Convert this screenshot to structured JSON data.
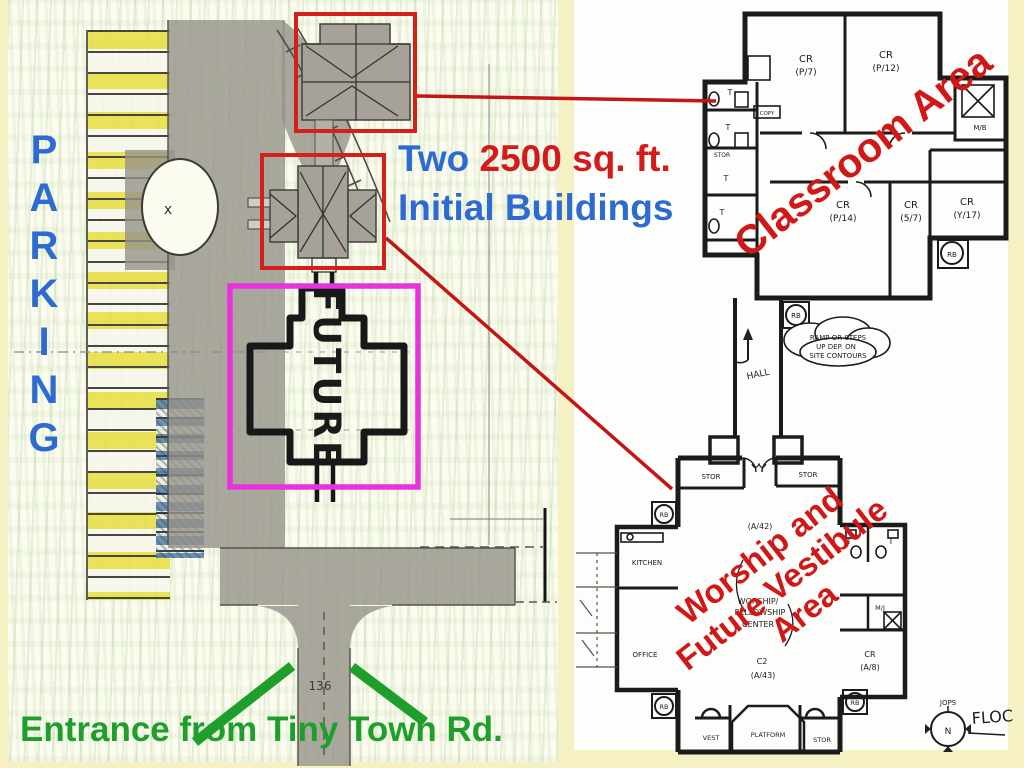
{
  "slide": {
    "caption": {
      "word_two": "Two",
      "size": "2500 sq. ft.",
      "line2": "Initial Buildings"
    },
    "parking_letters": [
      "P",
      "A",
      "R",
      "K",
      "I",
      "N",
      "G"
    ],
    "entrance_label": "Entrance from Tiny Town Rd.",
    "future_label": "FUTURE",
    "island_mark": "x",
    "drive_dimension": "136"
  },
  "classroom": {
    "title": "Classroom Area",
    "cr": "CR",
    "r1": "(P/7)",
    "r2": "(P/12)",
    "r3": "(P/14)",
    "r4": "(5/7)",
    "r5": "(Y/17)",
    "mb": "M/B",
    "stor": "STOR",
    "copy": "COPY",
    "t": "T",
    "rb": "RB",
    "hall": "HALL",
    "note_line1": "RAMP OR STEPS",
    "note_line2": "UP DEP. ON",
    "note_line3": "SITE CONTOURS"
  },
  "worship": {
    "title_line1": "Worship and",
    "title_line2": "Future Vestibule",
    "title_line3": "Area",
    "stor": "STOR",
    "kitchen": "KITCHEN",
    "office": "OFFICE",
    "center_line1": "WORSHIP/",
    "center_line2": "FELLOWSHIP",
    "center_line3": "CENTER",
    "center_code": "C2",
    "center_seats": "(A/43)",
    "upper_code": "(A/42)",
    "t": "T",
    "mj": "M/J",
    "cr": "CR",
    "cr_seats": "(A/8)",
    "rb": "RB",
    "vest": "VEST",
    "platform": "PLATFORM",
    "compass_n": "N",
    "compass_initials": "JOPS",
    "floor_note": "FLOC"
  },
  "colors": {
    "background": "#F6F1C4",
    "blue": "#2E6BD0",
    "red": "#D41A1A",
    "green": "#1F9E2C",
    "magenta": "#E832DC",
    "highlight_box_red": "#D3201A"
  }
}
